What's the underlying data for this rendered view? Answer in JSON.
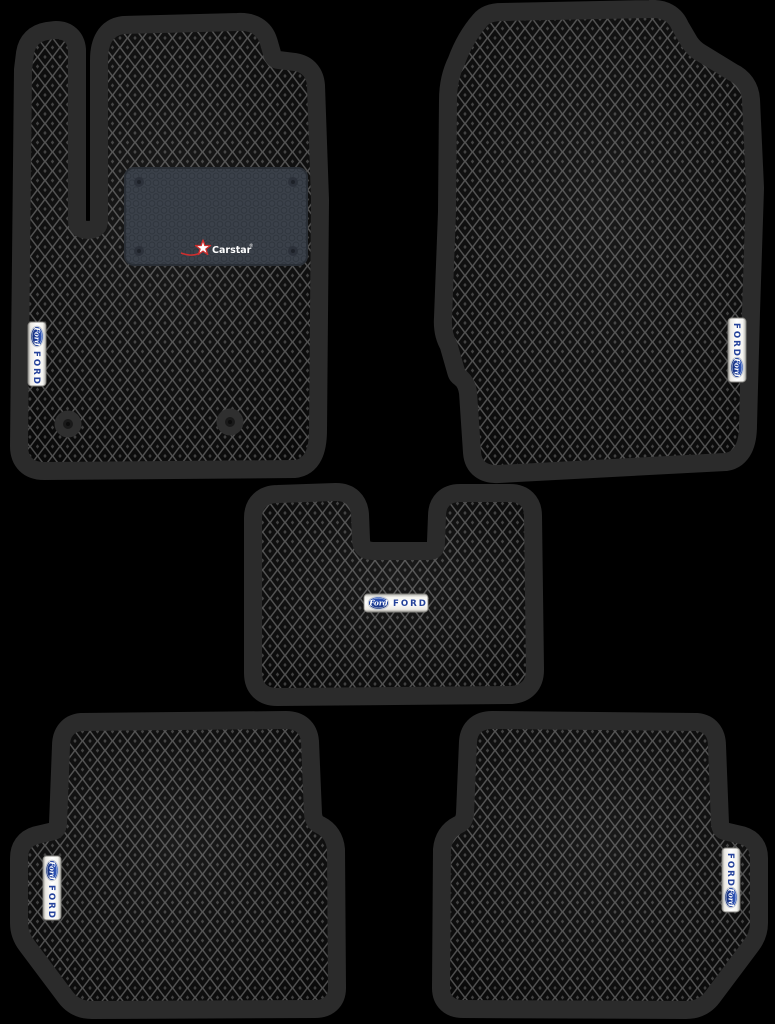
{
  "product": {
    "set_pieces": 5,
    "badge": {
      "script": "Ford",
      "wordmark": "FORD",
      "oval_color": "#26439b",
      "strip_color": "#f2f1ed"
    },
    "heel_pad": {
      "brand": "Carstar",
      "registered_mark": "®",
      "pad_color": "#3b414a",
      "star_color": "#cf2e2e",
      "text_color": "#ffffff"
    },
    "colors": {
      "background": "#000000",
      "mat_border": "#2b2b2b",
      "mat_cell": "#090909",
      "mat_lattice": "#4d4d4d",
      "cell_dot": "#3e3e3e"
    },
    "mats": [
      {
        "name": "front-driver-mat",
        "badge": "FORD",
        "badge_orientation": "vertical",
        "heel_pad_brand": "Carstar",
        "fastener_count": 2
      },
      {
        "name": "front-passenger-mat",
        "badge": "FORD",
        "badge_orientation": "vertical"
      },
      {
        "name": "center-tunnel-mat",
        "badge": "FORD",
        "badge_orientation": "horizontal"
      },
      {
        "name": "rear-left-mat",
        "badge": "FORD",
        "badge_orientation": "vertical"
      },
      {
        "name": "rear-right-mat",
        "badge": "FORD",
        "badge_orientation": "vertical"
      }
    ]
  }
}
